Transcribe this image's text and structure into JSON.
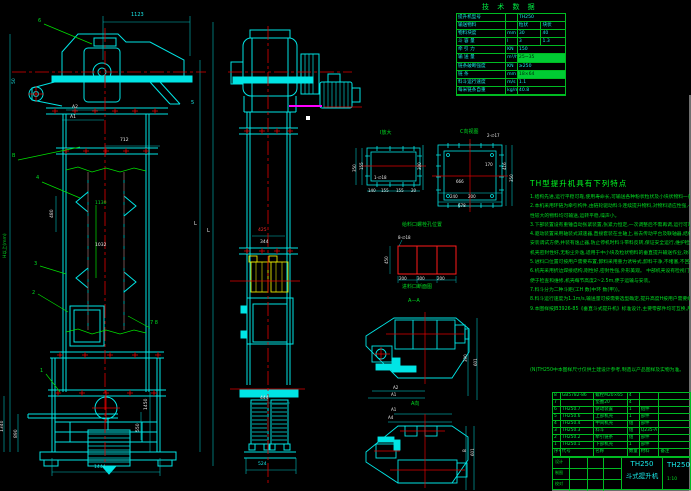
{
  "colors": {
    "background": "#000000",
    "line_cyan": "#00e5e5",
    "centerline_red": "#e00000",
    "annotation_green": "#00dd22",
    "bucket_yellow": "#e8e800",
    "highlight_magenta": "#ff00ff",
    "text_white": "#e8e8e8"
  },
  "tech_table": {
    "title": "技 术 数 据",
    "rows": [
      [
        "提升机型号",
        "",
        "TH250",
        null,
        false
      ],
      [
        "输送物料",
        "",
        "粒状",
        "块状",
        false
      ],
      [
        "物料块度",
        "mm",
        "30",
        "40",
        false
      ],
      [
        "斗 容 量",
        "l",
        "3",
        "1.3",
        false
      ],
      [
        "牵 引 力",
        "KN",
        "150",
        null,
        false
      ],
      [
        "输 送 量",
        "m³/h",
        "25~35",
        null,
        true
      ],
      [
        "链条破断强度",
        "KN",
        "≥250",
        null,
        false
      ],
      [
        "链    条",
        "mm",
        "18×64",
        null,
        true
      ],
      [
        "料斗运行速度",
        "m/s",
        "1.1",
        null,
        false
      ],
      [
        "每米链条自重",
        "kg/m",
        "40.8",
        null,
        false
      ]
    ]
  },
  "features": {
    "heading": "TH型提升机具有下列特点",
    "lines": [
      "1.结构先进,运行平稳可靠,使用寿命长,可输送各种粉状粒状及小块状物料一般。",
      "2.本机采用环链为牵引构件,由链轮驱动料斗连续提升物料,对物料适应性强,一般块状、磨琢",
      "  性较大的物料均可输送,运转平稳,噪声小。",
      "3.下部装置设有重锤自动张紧装置,张紧力恒定,一次调整后不需再调,运行可靠不跳链不脱链。",
      "4.驱动装置采用轴装式减速器,直接套装在主轴上,省去传动平台及联轴器,结构紧凑,重量轻,",
      "  安装调试方便,并装有逸止器,防止停机时料斗带料反转,保证安全运行,维护检修方便,",
      "  机壳密封性好,无粉尘外逸,适用于中小块及粒状物料的垂直提升输送作业,效率高。",
      "5.进料口位置可按用户需要布置,卸料采用重力诱导式,卸料干净,不堵塞,不回料。",
      "6.机壳采用折边焊接结构,刚性好,密封性强,外形美观。          中部机壳设有检视门,",
      "  便于检查和维修,机壳每节高度2~2.5m,便于运输与安装。",
      "7.料斗分为二种斗距(工H 数(中环 数(甲))。",
      "8.料斗运行速度为1.1m/s,输送量可按需要选型确定,提升高度H按用户需要组合。",
      "9.本图样按JB3926-85《垂直斗式提升机》标准设计,主要零部件均可互换,用户可选用。"
    ],
    "note": "(N)TH250中本图样尺寸仅供土建设计参考,制造以产品图样及实物为准。"
  },
  "parts_list": {
    "header": [
      "序号",
      "代号",
      "名称",
      "数量",
      "材料",
      "备注"
    ],
    "rows": [
      [
        "8",
        "GB5782-86",
        "螺栓M20×65",
        "4",
        "",
        ""
      ],
      [
        "7",
        "",
        "垫圈20",
        "4",
        "",
        ""
      ],
      [
        "6",
        "TH250.7",
        "驱动装置",
        "1",
        "组件",
        ""
      ],
      [
        "5",
        "TH250.6",
        "上部机壳",
        "1",
        "部件",
        ""
      ],
      [
        "4",
        "TH250.4",
        "中间机壳",
        "组",
        "部件",
        ""
      ],
      [
        "3",
        "TH250.3",
        "料斗",
        "组",
        "Q235-A",
        ""
      ],
      [
        "2",
        "TH250.2",
        "牵引链条",
        "组",
        "部件",
        ""
      ],
      [
        "1",
        "TH250.1",
        "下部机壳",
        "1",
        "部件",
        ""
      ]
    ]
  },
  "title_block": {
    "model": "TH250",
    "name": "斗式提升机",
    "drawing_no": "TH250",
    "scale": "1:10",
    "sign_labels": [
      "设计",
      "制图",
      "校对"
    ]
  },
  "annotations": [
    {
      "n": "dim-1123",
      "x": 131,
      "y": 13,
      "t": "1123",
      "c": "c"
    },
    {
      "n": "balloon-6",
      "x": 38,
      "y": 19,
      "t": "6",
      "c": "g"
    },
    {
      "n": "dim-50",
      "x": 12,
      "y": 84,
      "t": "50",
      "c": "c",
      "r": 1,
      "fs": 4.5
    },
    {
      "n": "dim-a2",
      "x": 72,
      "y": 105,
      "t": "A2",
      "c": "w",
      "fs": 4.5
    },
    {
      "n": "dim-a1",
      "x": 70,
      "y": 115,
      "t": "A1",
      "c": "w",
      "fs": 4.5
    },
    {
      "n": "balloon-5",
      "x": 191,
      "y": 101,
      "t": "5",
      "c": "c"
    },
    {
      "n": "dim-712",
      "x": 120,
      "y": 138,
      "t": "712",
      "c": "w",
      "fs": 4.5
    },
    {
      "n": "balloon-b",
      "x": 12,
      "y": 154,
      "t": "B",
      "c": "g"
    },
    {
      "n": "balloon-4",
      "x": 36,
      "y": 176,
      "t": "4",
      "c": "g"
    },
    {
      "n": "dim-480",
      "x": 50,
      "y": 218,
      "t": "480",
      "c": "w",
      "r": 1,
      "fs": 4.5
    },
    {
      "n": "dim-1130",
      "x": 95,
      "y": 201,
      "t": "1130",
      "c": "g",
      "fs": 4.5
    },
    {
      "n": "dim-1032",
      "x": 95,
      "y": 243,
      "t": "1032",
      "c": "w",
      "fs": 4.5
    },
    {
      "n": "balloon-3",
      "x": 34,
      "y": 262,
      "t": "3",
      "c": "g"
    },
    {
      "n": "balloon-2",
      "x": 32,
      "y": 291,
      "t": "2",
      "c": "g"
    },
    {
      "n": "balloon-7-8",
      "x": 150,
      "y": 321,
      "t": "7 8",
      "c": "g"
    },
    {
      "n": "balloon-1",
      "x": 40,
      "y": 369,
      "t": "1",
      "c": "g"
    },
    {
      "n": "dim-total-height",
      "x": 3,
      "y": 258,
      "t": "H以上(mm)",
      "c": "g",
      "r": 1,
      "fs": 4.5
    },
    {
      "n": "dim-1340",
      "x": 0,
      "y": 432,
      "t": "1340",
      "c": "w",
      "r": 1,
      "fs": 4.5
    },
    {
      "n": "dim-890",
      "x": 14,
      "y": 438,
      "t": "890",
      "c": "w",
      "r": 1,
      "fs": 4.5
    },
    {
      "n": "dim-L-outer",
      "x": 194,
      "y": 222,
      "t": "L",
      "c": "w"
    },
    {
      "n": "dim-L-inner",
      "x": 207,
      "y": 229,
      "t": "L",
      "c": "w"
    },
    {
      "n": "dim-1450",
      "x": 144,
      "y": 410,
      "t": "1450",
      "c": "w",
      "r": 1,
      "fs": 4.5
    },
    {
      "n": "dim-550",
      "x": 136,
      "y": 432,
      "t": "550",
      "c": "w",
      "r": 1,
      "fs": 4.5
    },
    {
      "n": "dim-1444",
      "x": 94,
      "y": 465,
      "t": "1444",
      "c": "c",
      "fs": 4.5
    },
    {
      "n": "dim-425",
      "x": 258,
      "y": 228,
      "t": "425",
      "c": "r",
      "fs": 4.5
    },
    {
      "n": "dim-344",
      "x": 260,
      "y": 240,
      "t": "344",
      "c": "w",
      "fs": 4.5
    },
    {
      "n": "dim-444",
      "x": 260,
      "y": 396,
      "t": "444",
      "c": "w",
      "fs": 4.5
    },
    {
      "n": "dim-524",
      "x": 258,
      "y": 462,
      "t": "524",
      "c": "c",
      "fs": 4.5
    },
    {
      "n": "view-title-I",
      "x": 380,
      "y": 131,
      "t": "Ⅰ放大",
      "c": "g",
      "fs": 5
    },
    {
      "n": "note-1-d18",
      "x": 374,
      "y": 175,
      "t": "1-∅18",
      "c": "w",
      "fs": 4
    },
    {
      "n": "dim-140",
      "x": 368,
      "y": 188,
      "t": "140",
      "c": "w",
      "fs": 4
    },
    {
      "n": "dim-155a",
      "x": 381,
      "y": 188,
      "t": "155",
      "c": "w",
      "fs": 4
    },
    {
      "n": "dim-155b",
      "x": 396,
      "y": 188,
      "t": "155",
      "c": "w",
      "fs": 4
    },
    {
      "n": "dim-20",
      "x": 411,
      "y": 188,
      "t": "20",
      "c": "w",
      "fs": 4
    },
    {
      "n": "dim-350-left",
      "x": 352,
      "y": 172,
      "t": "350",
      "c": "w",
      "r": 1,
      "fs": 4
    },
    {
      "n": "dim-155c",
      "x": 359,
      "y": 170,
      "t": "155",
      "c": "w",
      "r": 1,
      "fs": 4
    },
    {
      "n": "dim-300",
      "x": 417,
      "y": 170,
      "t": "300",
      "c": "w",
      "r": 1,
      "fs": 4
    },
    {
      "n": "view-title-C",
      "x": 460,
      "y": 130,
      "t": "C向视图",
      "c": "g",
      "fs": 5
    },
    {
      "n": "note-2-d17",
      "x": 487,
      "y": 133,
      "t": "2-∅17",
      "c": "w",
      "fs": 4
    },
    {
      "n": "dim-666",
      "x": 456,
      "y": 179,
      "t": "666",
      "c": "w",
      "fs": 4
    },
    {
      "n": "dim-170",
      "x": 485,
      "y": 162,
      "t": "170",
      "c": "w",
      "fs": 4
    },
    {
      "n": "dim-240",
      "x": 450,
      "y": 194,
      "t": "240",
      "c": "w",
      "fs": 4
    },
    {
      "n": "dim-200a",
      "x": 468,
      "y": 194,
      "t": "200",
      "c": "w",
      "fs": 4
    },
    {
      "n": "dim-678",
      "x": 458,
      "y": 203,
      "t": "678",
      "c": "w",
      "fs": 4
    },
    {
      "n": "dim-416",
      "x": 502,
      "y": 170,
      "t": "416",
      "c": "w",
      "r": 1,
      "fs": 4
    },
    {
      "n": "dim-350b",
      "x": 509,
      "y": 182,
      "t": "350",
      "c": "w",
      "r": 1,
      "fs": 4
    },
    {
      "n": "detail-title-bolt-holes",
      "x": 402,
      "y": 223,
      "t": "给料口螺栓孔位置",
      "c": "g",
      "fs": 5
    },
    {
      "n": "note-8-d18",
      "x": 398,
      "y": 235,
      "t": "8-∅18",
      "c": "w",
      "fs": 4
    },
    {
      "n": "dim-450",
      "x": 384,
      "y": 264,
      "t": "450",
      "c": "w",
      "r": 1,
      "fs": 4
    },
    {
      "n": "dim-200b",
      "x": 399,
      "y": 276,
      "t": "200",
      "c": "w",
      "fs": 4
    },
    {
      "n": "dim-300b",
      "x": 417,
      "y": 276,
      "t": "300",
      "c": "w",
      "fs": 4
    },
    {
      "n": "dim-200c",
      "x": 437,
      "y": 276,
      "t": "200",
      "c": "w",
      "fs": 4
    },
    {
      "n": "detail-title-inlet-section",
      "x": 402,
      "y": 285,
      "t": "进料口断面图",
      "c": "g",
      "fs": 5
    },
    {
      "n": "view-label-a-a",
      "x": 408,
      "y": 299,
      "t": "A—A",
      "c": "g",
      "fs": 5
    },
    {
      "n": "dim-390",
      "x": 463,
      "y": 362,
      "t": "390",
      "c": "w",
      "r": 1,
      "fs": 4
    },
    {
      "n": "dim-601",
      "x": 473,
      "y": 366,
      "t": "601",
      "c": "w",
      "r": 1,
      "fs": 4
    },
    {
      "n": "dim-a2-plan",
      "x": 393,
      "y": 385,
      "t": "A2",
      "c": "w",
      "fs": 4
    },
    {
      "n": "dim-a1-plan",
      "x": 391,
      "y": 392,
      "t": "A1",
      "c": "w",
      "fs": 4
    },
    {
      "n": "view-caption-a",
      "x": 411,
      "y": 402,
      "t": "A向",
      "c": "g",
      "fs": 5
    },
    {
      "n": "dim-a1-planb",
      "x": 391,
      "y": 407,
      "t": "A1",
      "c": "w",
      "fs": 4
    },
    {
      "n": "dim-a4-planb",
      "x": 388,
      "y": 415,
      "t": "A4",
      "c": "w",
      "fs": 4
    },
    {
      "n": "dim-b-planb",
      "x": 462,
      "y": 452,
      "t": "B",
      "c": "w",
      "r": 1,
      "fs": 4
    },
    {
      "n": "dim-601b",
      "x": 470,
      "y": 456,
      "t": "601",
      "c": "w",
      "r": 1,
      "fs": 4
    }
  ]
}
